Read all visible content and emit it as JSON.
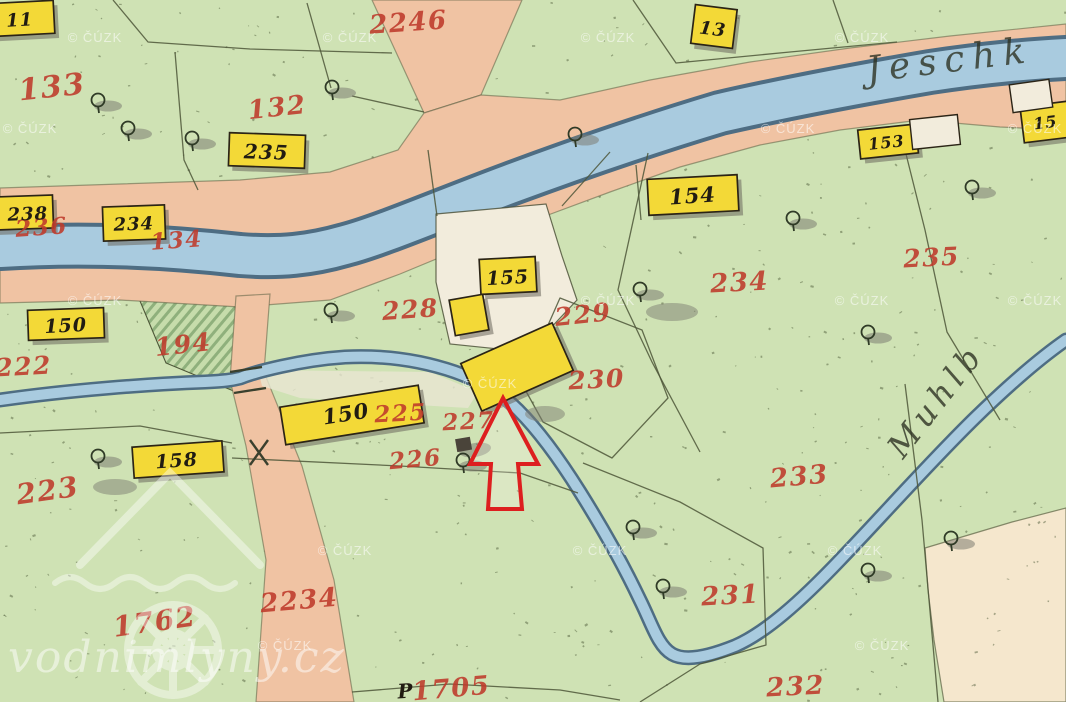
{
  "map": {
    "description": "Historical hand-drawn cadastral map with mill parcel highlighted by red arrow",
    "watermark": "© ČÚZK",
    "site_watermark": "vodnimlyny.cz",
    "rivers": {
      "jeschk": "Jeschk",
      "muhlb": "Muhlb"
    },
    "buildings": {
      "b11": "11",
      "b235": "235",
      "b238": "238",
      "b234": "234",
      "b150a": "150",
      "b158": "158",
      "b150b": "150",
      "b154": "154",
      "b155": "155",
      "b13": "13",
      "b153": "153",
      "b152": "15"
    },
    "parcels": {
      "p133": "133",
      "p132": "132",
      "p2246": "2246",
      "p236": "236",
      "p134": "134",
      "p194": "194",
      "p222": "222",
      "p223": "223",
      "p228": "228",
      "p229": "229",
      "p230": "230",
      "p234": "234",
      "p235": "235",
      "p225": "225",
      "p227": "227",
      "p226": "226",
      "p233": "233",
      "p231": "231",
      "p232": "232",
      "p1762": "1762",
      "p2234": "2234",
      "p1705": "1705",
      "p1705_prefix": "P"
    },
    "colors": {
      "field_green": "#cfe2b4",
      "road_salmon": "#f0c3a3",
      "water_blue": "#a9cbdf",
      "building_yellow": "#f3d937",
      "parcel_red": "#bf3a2b",
      "cream": "#f2ecdc",
      "beige": "#f5e7cd",
      "arrow_red": "#dd1f1f"
    }
  }
}
